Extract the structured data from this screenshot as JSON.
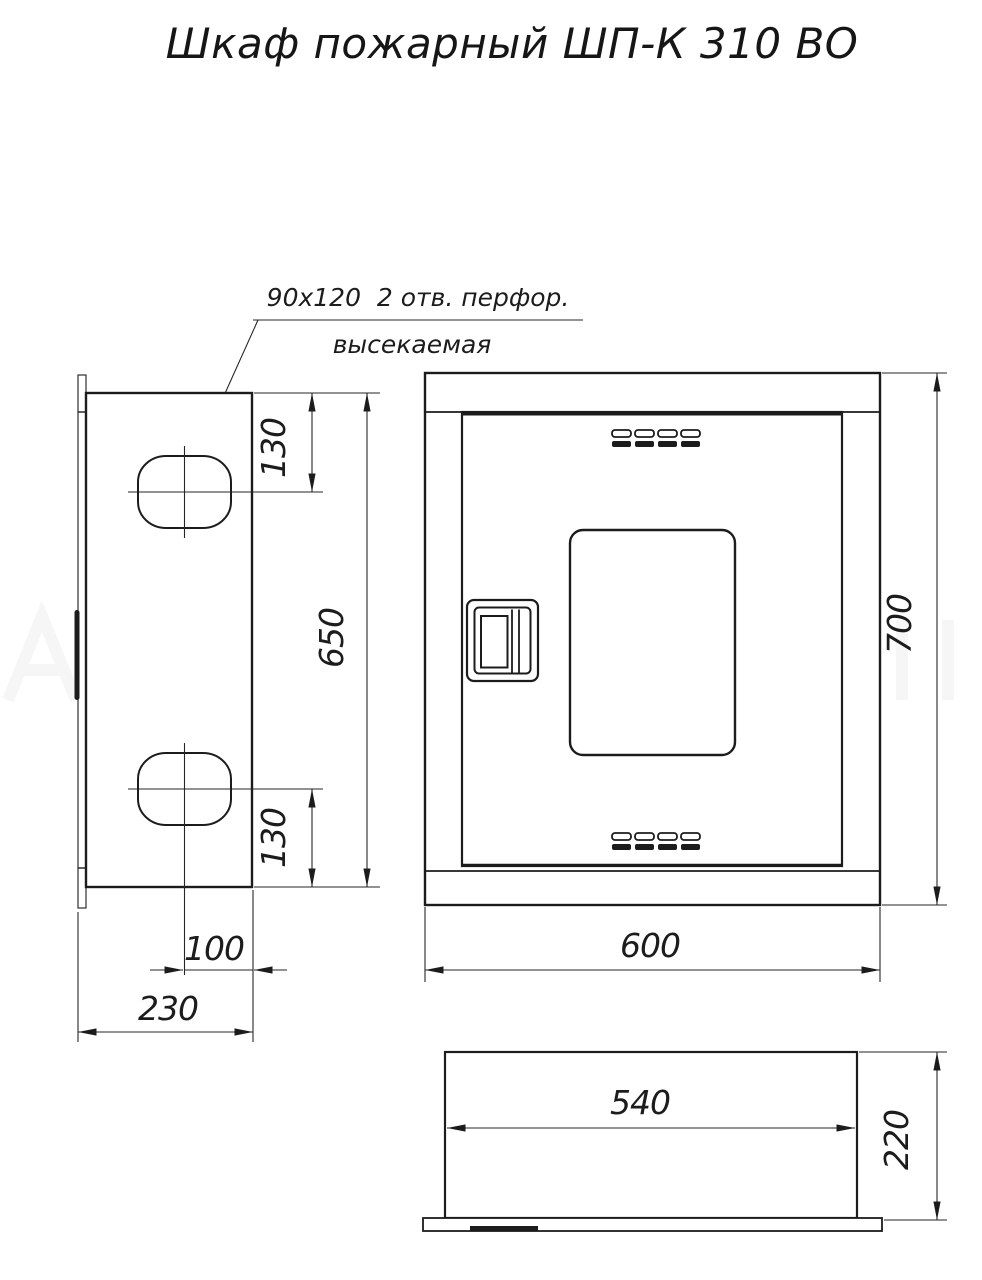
{
  "title": "Шкаф пожарный ШП-К 310 ВО",
  "annotation": {
    "line1": "90x120  2 отв. перфор.",
    "line2": "высекаемая"
  },
  "side_view": {
    "dim_hole_top_offset": "130",
    "dim_mount_span": "650",
    "dim_hole_bottom_offset": "130",
    "dim_hole_inset": "100",
    "dim_depth": "230"
  },
  "front_view": {
    "dim_width": "600",
    "dim_height": "700"
  },
  "top_view": {
    "dim_inner_width": "540",
    "dim_depth": "220"
  },
  "colors": {
    "line": "#1c1c1c",
    "dimension": "#262626",
    "background": "#ffffff"
  }
}
